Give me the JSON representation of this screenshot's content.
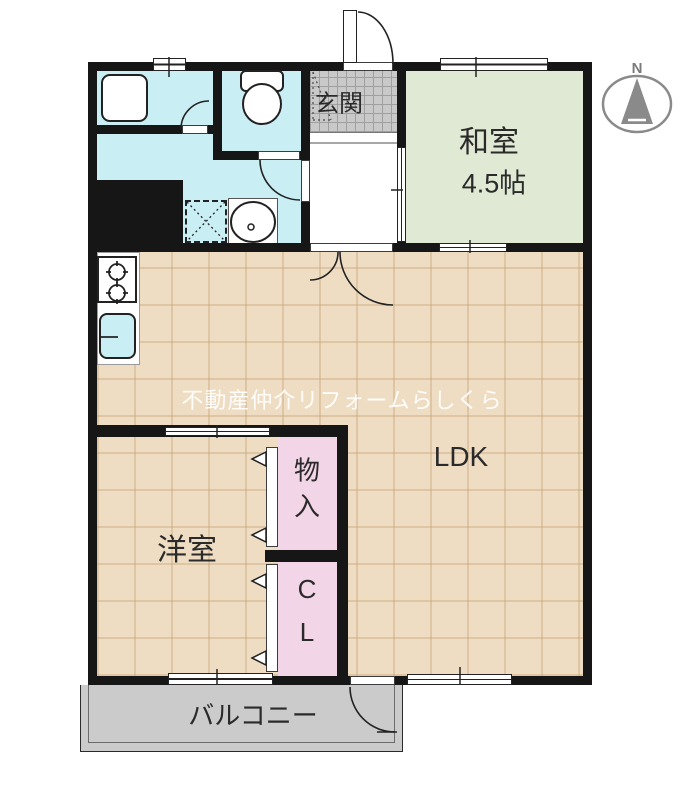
{
  "compass": {
    "label": "N"
  },
  "rooms": {
    "genkan": {
      "label": "玄関"
    },
    "washitsu": {
      "label": "和室",
      "size": "4.5帖"
    },
    "ldk": {
      "label": "LDK"
    },
    "yoshitsu": {
      "label": "洋室"
    },
    "closet_upper": {
      "label": "物入",
      "char1": "物",
      "char2": "入"
    },
    "closet_lower": {
      "label": "CL",
      "char1": "C",
      "char2": "L"
    },
    "balcony": {
      "label": "バルコニー"
    }
  },
  "watermark": {
    "text": "不動産仲介リフォームらしくら"
  },
  "fixtures": [
    "bathtub",
    "toilet",
    "wash-basin",
    "washing-machine-space",
    "gas-stove",
    "kitchen-sink",
    "entrance-door",
    "balcony-door"
  ],
  "colors": {
    "wall": "#161616",
    "wet_area": "#c9eef4",
    "tatami": "#e0e9d4",
    "flooring": "#eeddc3",
    "flooring_grid": "#dfc8a8",
    "entrance_tile": "#c9c9c9",
    "closet": "#f2d5e6",
    "balcony": "#cbcbcb",
    "watermark_text": "#ffffff",
    "compass": "#8a8a8a"
  }
}
